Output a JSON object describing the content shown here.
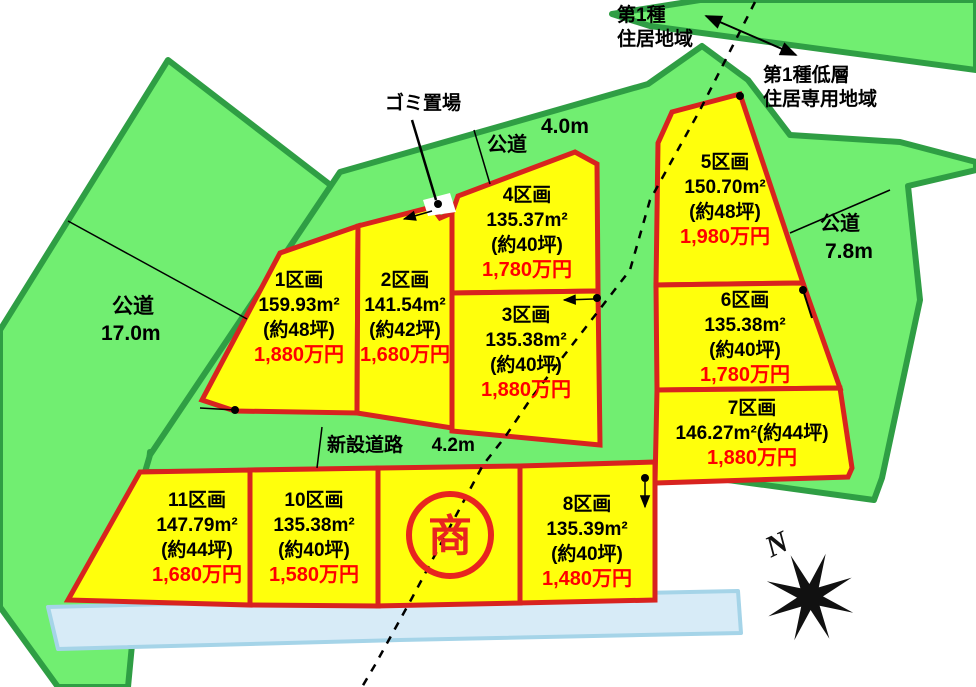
{
  "title": "宅地分譲区画図",
  "zones": {
    "zone1_line1": "第1種",
    "zone1_line2": "住居地域",
    "zone2_line1": "第1種低層",
    "zone2_line2": "住居専用地域"
  },
  "roads": {
    "top": {
      "name": "公道",
      "width": "4.0m"
    },
    "left": {
      "name": "公道",
      "width": "17.0m"
    },
    "right": {
      "name": "公道",
      "width": "7.8m"
    },
    "new": {
      "name": "新設道路",
      "width": "4.2m"
    }
  },
  "garbage_label": "ゴミ置場",
  "sho": {
    "label": "商"
  },
  "compass": {
    "label": "N"
  },
  "lots": [
    {
      "id": "1",
      "name": "1区画",
      "area": "159.93m²",
      "tsubo": "(約48坪)",
      "price": "1,880万円"
    },
    {
      "id": "2",
      "name": "2区画",
      "area": "141.54m²",
      "tsubo": "(約42坪)",
      "price": "1,680万円"
    },
    {
      "id": "3",
      "name": "3区画",
      "area": "135.38m²",
      "tsubo": "(約40坪)",
      "price": "1,880万円"
    },
    {
      "id": "4",
      "name": "4区画",
      "area": "135.37m²",
      "tsubo": "(約40坪)",
      "price": "1,780万円"
    },
    {
      "id": "5",
      "name": "5区画",
      "area": "150.70m²",
      "tsubo": "(約48坪)",
      "price": "1,980万円"
    },
    {
      "id": "6",
      "name": "6区画",
      "area": "135.38m²",
      "tsubo": "(約40坪)",
      "price": "1,780万円"
    },
    {
      "id": "7",
      "name": "7区画",
      "area": "146.27m²(約44坪)",
      "tsubo": "",
      "price": "1,880万円"
    },
    {
      "id": "8",
      "name": "8区画",
      "area": "135.39m²",
      "tsubo": "(約40坪)",
      "price": "1,480万円"
    },
    {
      "id": "10",
      "name": "10区画",
      "area": "135.38m²",
      "tsubo": "(約40坪)",
      "price": "1,580万円"
    },
    {
      "id": "11",
      "name": "11区画",
      "area": "147.79m²",
      "tsubo": "(約44坪)",
      "price": "1,680万円"
    }
  ],
  "colors": {
    "road_green": "#71ee71",
    "green_edge": "#2f9e44",
    "lot_fill": "#ffff0c",
    "lot_border": "#d8231f",
    "price_red": "#ff0000",
    "water_blue": "#d7ebf7"
  }
}
